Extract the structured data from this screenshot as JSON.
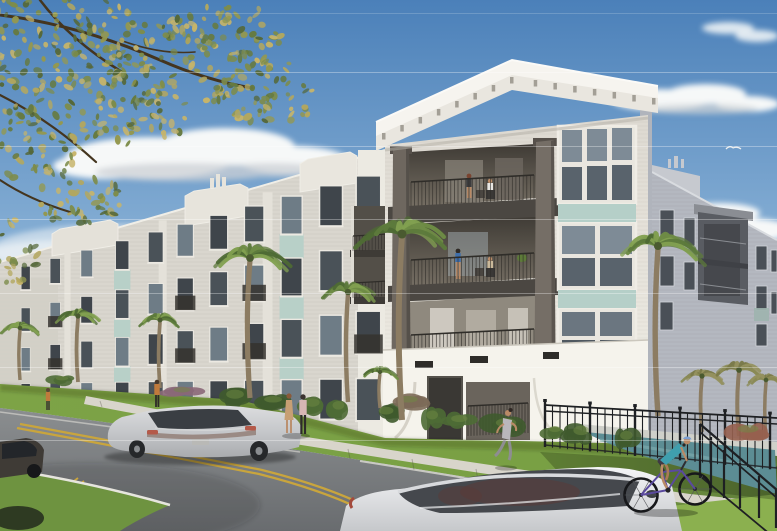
{
  "meta": {
    "type": "architectural-rendering",
    "description": "Sunny street-level rendering of a four-story white coastal-style apartment complex with stepped parapet gables, recessed balconies with residents, seafoam accent panels, palm trees, a curving street with cars, pedestrians, a jogger, a cyclist on the sidewalk, and a fenced pool area at right"
  },
  "scene": {
    "objects": [
      {
        "name": "sky",
        "label": "blue sky with scattered clouds"
      },
      {
        "name": "bird",
        "label": "distant bird in flight"
      },
      {
        "name": "street-tree",
        "label": "overhanging tree foliage, upper left"
      },
      {
        "name": "apartment-building",
        "label": "four-story white apartment building",
        "floors": 4
      },
      {
        "name": "tower-balconies",
        "label": "stacked corner balconies",
        "residents": 4
      },
      {
        "name": "palm-trees",
        "label": "palm trees along facade",
        "count": 10
      },
      {
        "name": "street",
        "label": "curving asphalt street with double yellow center lines"
      },
      {
        "name": "sidewalk",
        "label": "concrete sidewalk along building"
      },
      {
        "name": "silver-sedan",
        "label": "silver sedan driving away"
      },
      {
        "name": "white-sedan",
        "label": "white sedan in foreground"
      },
      {
        "name": "dark-car",
        "label": "partial dark car at left edge"
      },
      {
        "name": "pedestrians",
        "label": "people walking on sidewalk",
        "count": 4
      },
      {
        "name": "jogger",
        "label": "jogger in gray activewear",
        "count": 1
      },
      {
        "name": "cyclist",
        "label": "cyclist in teal top with blue helmet",
        "count": 1
      },
      {
        "name": "metal-fence",
        "label": "black metal picket fence"
      },
      {
        "name": "pool",
        "label": "pool water behind fence"
      }
    ]
  },
  "colors": {
    "sky_top": "#4b80b9",
    "sky_mid": "#85aed4",
    "sky_low": "#c9dde9",
    "cloud": "#f6f8f8",
    "cloud_shadow": "#ccd1d6",
    "foliage_dark": "#55683a",
    "foliage_mid": "#7d8c4b",
    "foliage_light": "#b3a75f",
    "branch": "#44351f",
    "wall_sun": "#e7e4dc",
    "wall_bright": "#f3f1e9",
    "wall_far": "#d9d6ce",
    "wall_shadow": "#b6bac2",
    "trim_white": "#f0eee7",
    "fascia": "#e9e6df",
    "roof_white": "#f6f4ef",
    "eave_shadow": "#b7b3aa",
    "bracket": "#a39f96",
    "column": "#6e675f",
    "column_dark": "#57514b",
    "slab": "#4b4742",
    "balcony_interior": "#6b655c",
    "balcony_dark": "#45413b",
    "rail": "#2f2d29",
    "glass_dark": "#41474d",
    "glass_sky": "#7e8b96",
    "glass_mid": "#59636c",
    "accent_teal": "#b5cfc8",
    "accent_teal_shade": "#93aca6",
    "stucco": "#f5f3ec",
    "vent": "#2e2c29",
    "door": "#3a3834",
    "grass_sun": "#7ea447",
    "grass_bright": "#8bb04f",
    "grass_shadow": "#5d7a39",
    "verge": "#85a84c",
    "sidewalk": "#d8d5cb",
    "curb": "#e6e5de",
    "asphalt": "#85888a",
    "asphalt_dark": "#6a6d70",
    "yellow_line": "#c9a53d",
    "white_line": "#dddcd5",
    "fence": "#1e2023",
    "pool": "#5c8d94",
    "pool_light": "#7aa8ad",
    "car_silver": "#c7c9cb",
    "car_white": "#edeff1",
    "car_glass": "#3c4045",
    "taillight": "#b45a4a",
    "skin": "#b98a66",
    "palm_green": "#6f8c46",
    "palm_green_dark": "#4e6a34",
    "palm_dry": "#95915f",
    "trunk": "#8c7c62",
    "jogger_gray": "#8e8d92",
    "walker_pink": "#d7b6b4",
    "walker_tan": "#c79f74",
    "shirt_orange": "#c07a3c",
    "cyclist_teal": "#3f9fae",
    "helmet_blue": "#7c9fd2",
    "bike_purple": "#5a4a9e"
  }
}
